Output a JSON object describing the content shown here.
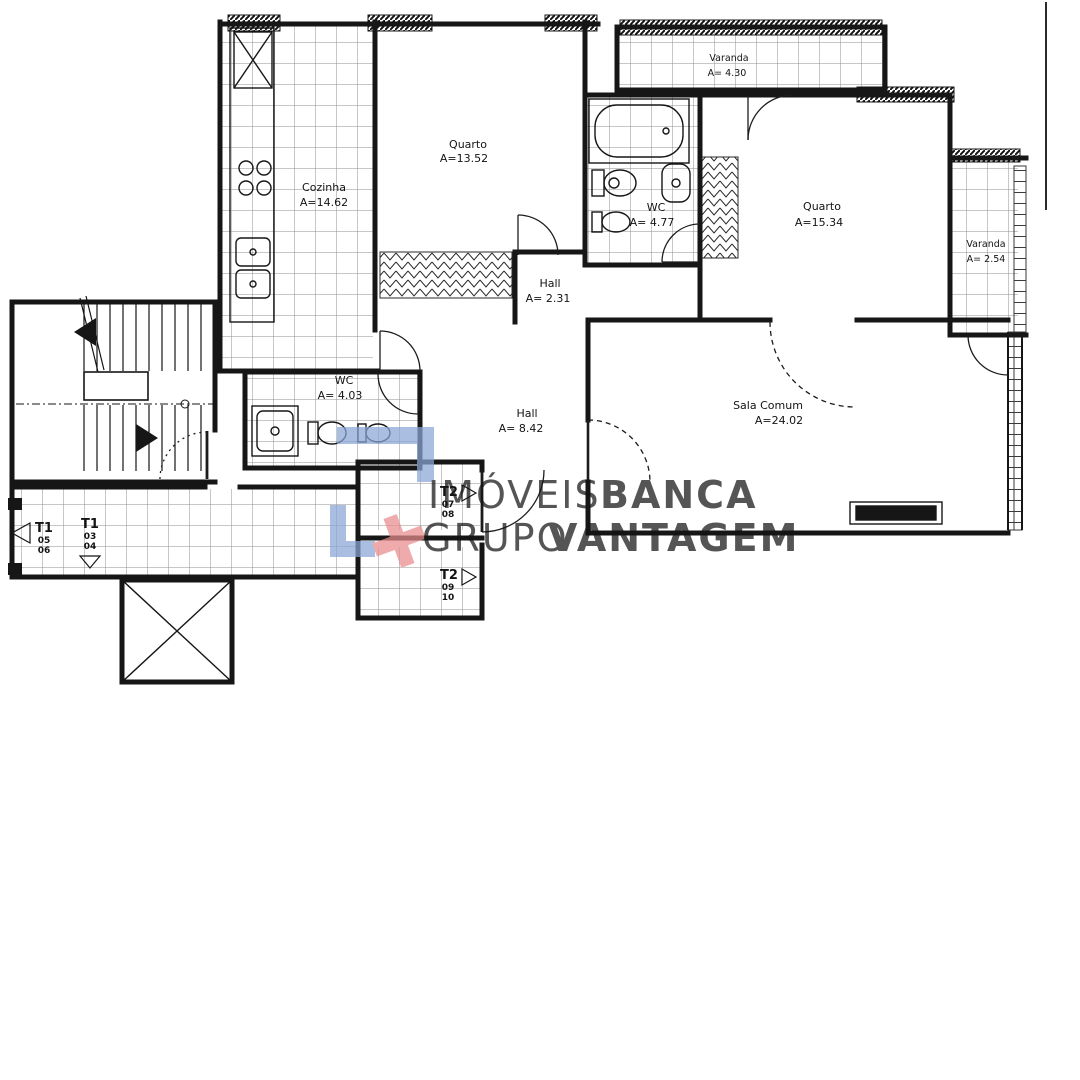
{
  "plan_title": "Floor plan T2",
  "rooms": {
    "quarto1": {
      "name": "Quarto",
      "area": "A=13.52"
    },
    "cozinha": {
      "name": "Cozinha",
      "area": "A=14.62"
    },
    "wc1": {
      "name": "WC",
      "area": "A= 4.77"
    },
    "quarto2": {
      "name": "Quarto",
      "area": "A=15.34"
    },
    "varanda1": {
      "name": "Varanda",
      "area": "A= 4.30"
    },
    "varanda2": {
      "name": "Varanda",
      "area": "A= 2.54"
    },
    "hall1": {
      "name": "Hall",
      "area": "A= 2.31"
    },
    "wc2": {
      "name": "WC",
      "area": "A= 4.03"
    },
    "hall2": {
      "name": "Hall",
      "area": "A= 8.42"
    },
    "sala": {
      "name": "Sala Comum",
      "area": "A=24.02"
    }
  },
  "units": {
    "t1_left": {
      "type": "T1",
      "num_top": "05",
      "num_bottom": "06"
    },
    "t1_right": {
      "type": "T1",
      "num_top": "03",
      "num_bottom": "04"
    },
    "t2_top": {
      "type": "T2",
      "num_top": "07",
      "num_bottom": "08"
    },
    "t2_bottom": {
      "type": "T2",
      "num_top": "09",
      "num_bottom": "10"
    }
  },
  "watermark": {
    "word1": "IMÓVEIS",
    "word2": "BANCA",
    "word3": "GRUPO",
    "word4": "VANTAGEM",
    "colors": {
      "word1": "#c9c9c9",
      "word2": "#ee8d8d",
      "word3": "#bcc7da",
      "word4": "#6e93ca",
      "mark_blue": "#8aa6d6",
      "mark_red": "#e98c8c"
    }
  },
  "drawing": {
    "line_color": "#161616",
    "background": "#ffffff"
  }
}
